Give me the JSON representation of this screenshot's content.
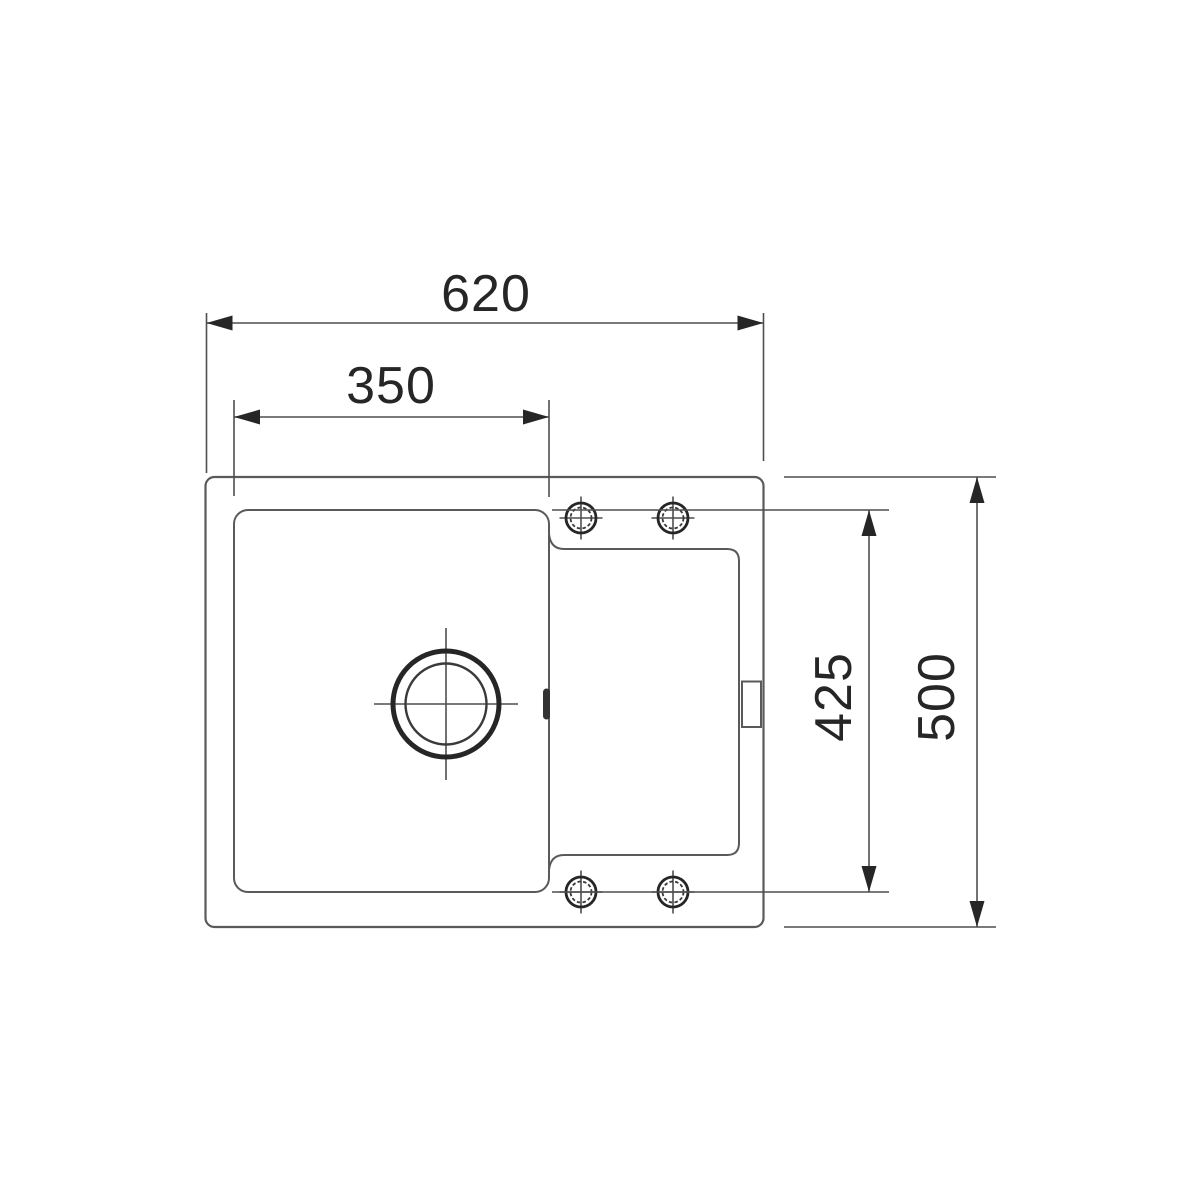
{
  "drawing": {
    "dimensions": {
      "overall_width_mm": "620",
      "bowl_width_mm": "350",
      "recess_depth_mm": "425",
      "overall_depth_mm": "500"
    },
    "colors": {
      "background": "#ffffff",
      "outline_gray": "#5a5a5a",
      "dimension_gray": "#4f4f4f",
      "ink_black": "#262626"
    }
  }
}
